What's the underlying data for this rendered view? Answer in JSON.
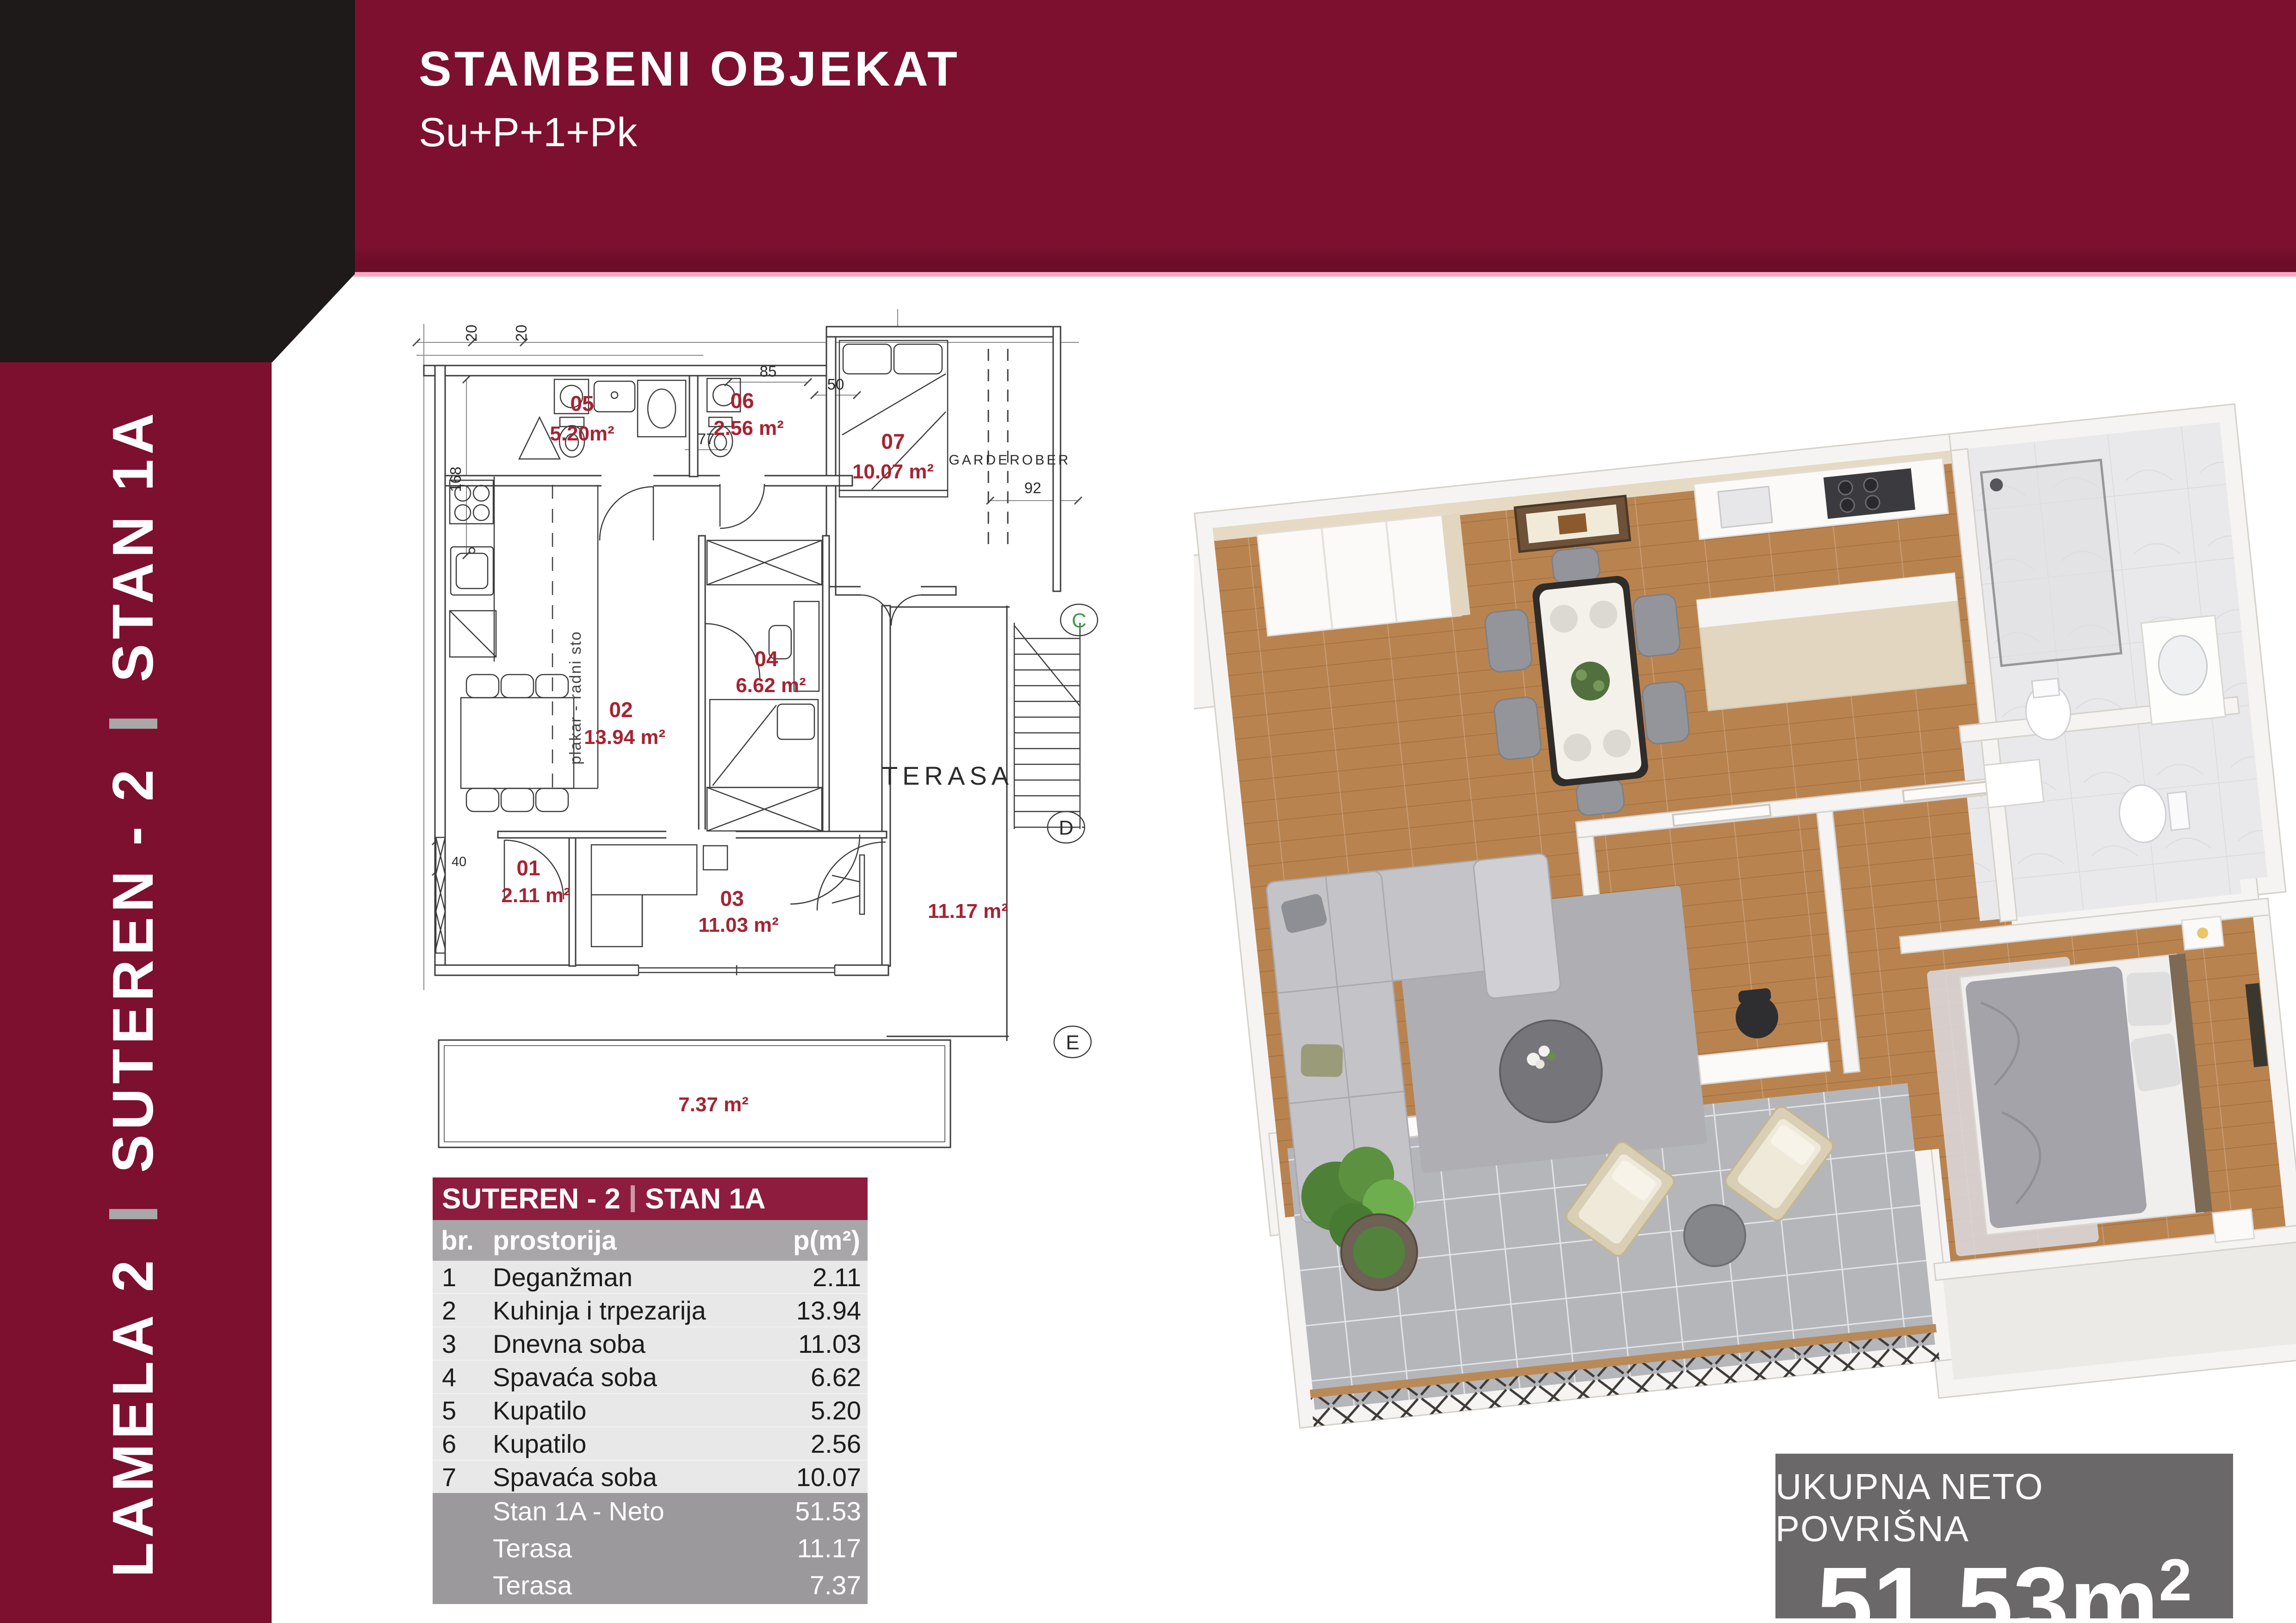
{
  "header": {
    "title": "STAMBENI OBJEKAT",
    "subtitle": "Su+P+1+Pk"
  },
  "sidebar": {
    "segments": [
      "LAMELA 2",
      "SUTEREN - 2",
      "STAN 1A"
    ]
  },
  "colors": {
    "brand": "#7D102F",
    "table_title": "#8E1C3E",
    "gray_head": "#A8A6A9",
    "gray_foot": "#9B999C",
    "summary_bg": "#6B6869",
    "accent_pink": "#F5A9C4",
    "room_label_red": "#A62433"
  },
  "table": {
    "title_left": "SUTEREN - 2",
    "title_right": "STAN 1A",
    "columns": {
      "num": "br.",
      "name": "prostorija",
      "val": "p(m²)"
    },
    "rows": [
      {
        "num": "1",
        "name": "Deganžman",
        "val": "2.11"
      },
      {
        "num": "2",
        "name": "Kuhinja i trpezarija",
        "val": "13.94"
      },
      {
        "num": "3",
        "name": "Dnevna soba",
        "val": "11.03"
      },
      {
        "num": "4",
        "name": "Spavaća soba",
        "val": "6.62"
      },
      {
        "num": "5",
        "name": "Kupatilo",
        "val": "5.20"
      },
      {
        "num": "6",
        "name": "Kupatilo",
        "val": "2.56"
      },
      {
        "num": "7",
        "name": "Spavaća soba",
        "val": "10.07"
      }
    ],
    "footer": [
      {
        "name": "Stan 1A - Neto",
        "val": "51.53"
      },
      {
        "name": "Terasa",
        "val": "11.17"
      },
      {
        "name": "Terasa",
        "val": "7.37"
      }
    ]
  },
  "summary": {
    "label": "UKUPNA NETO POVRIŠNA",
    "value": "51.53m",
    "sup": "2"
  },
  "plan2d": {
    "r05": {
      "n": "05",
      "a": "5.20m²"
    },
    "r06": {
      "n": "06",
      "a": "2.56 m²"
    },
    "r07": {
      "n": "07",
      "a": "10.07 m²"
    },
    "r04": {
      "n": "04",
      "a": "6.62 m²"
    },
    "r02": {
      "n": "02",
      "a": "13.94 m²"
    },
    "r01": {
      "n": "01",
      "a": "2.11 m²"
    },
    "r03": {
      "n": "03",
      "a": "11.03 m²"
    },
    "t_right": "11.17 m²",
    "t_bottom": "7.37 m²",
    "terasa": "TERASA",
    "garderober": "GARDEROBER",
    "closet": "plakar - radni sto",
    "d20a": "20",
    "d20b": "20",
    "d168": "168",
    "d85": "85",
    "d77": "77",
    "d50": "50",
    "d92": "92",
    "d40": "40",
    "mC": "C",
    "mD": "D",
    "mE": "E"
  }
}
